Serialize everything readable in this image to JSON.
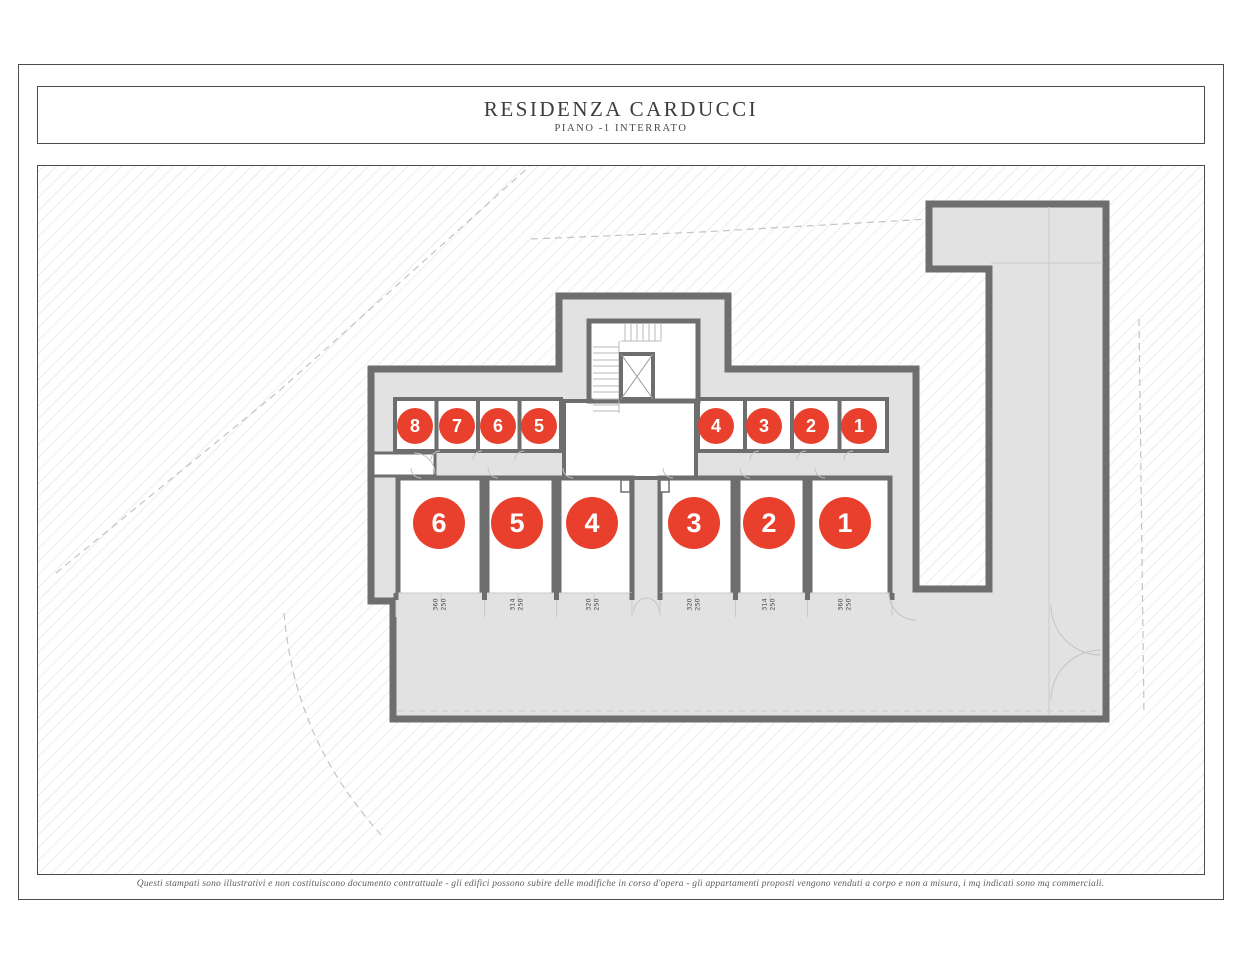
{
  "header": {
    "title": "RESIDENZA CARDUCCI",
    "subtitle": "PIANO -1 INTERRATO"
  },
  "footer": {
    "disclaimer": "Questi stampati sono illustrativi e non costituiscono documento contrattuale - gli edifici possono subire delle modifiche in corso d'opera - gli appartamenti proposti vengono venduti a corpo e non a misura, i mq indicati sono mq commerciali."
  },
  "plan": {
    "colors": {
      "badge_red": "#e8402c",
      "wall_gray": "#6e6e6e",
      "building_fill": "#e2e2e2"
    },
    "cellars": [
      {
        "label": "8"
      },
      {
        "label": "7"
      },
      {
        "label": "6"
      },
      {
        "label": "5"
      },
      {
        "label": "4"
      },
      {
        "label": "3"
      },
      {
        "label": "2"
      },
      {
        "label": "1"
      }
    ],
    "garages": [
      {
        "label": "6",
        "dims": [
          "360",
          "250"
        ]
      },
      {
        "label": "5",
        "dims": [
          "314",
          "250"
        ]
      },
      {
        "label": "4",
        "dims": [
          "320",
          "250"
        ]
      },
      {
        "label": "3",
        "dims": [
          "320",
          "250"
        ]
      },
      {
        "label": "2",
        "dims": [
          "314",
          "250"
        ]
      },
      {
        "label": "1",
        "dims": [
          "360",
          "250"
        ]
      }
    ]
  }
}
